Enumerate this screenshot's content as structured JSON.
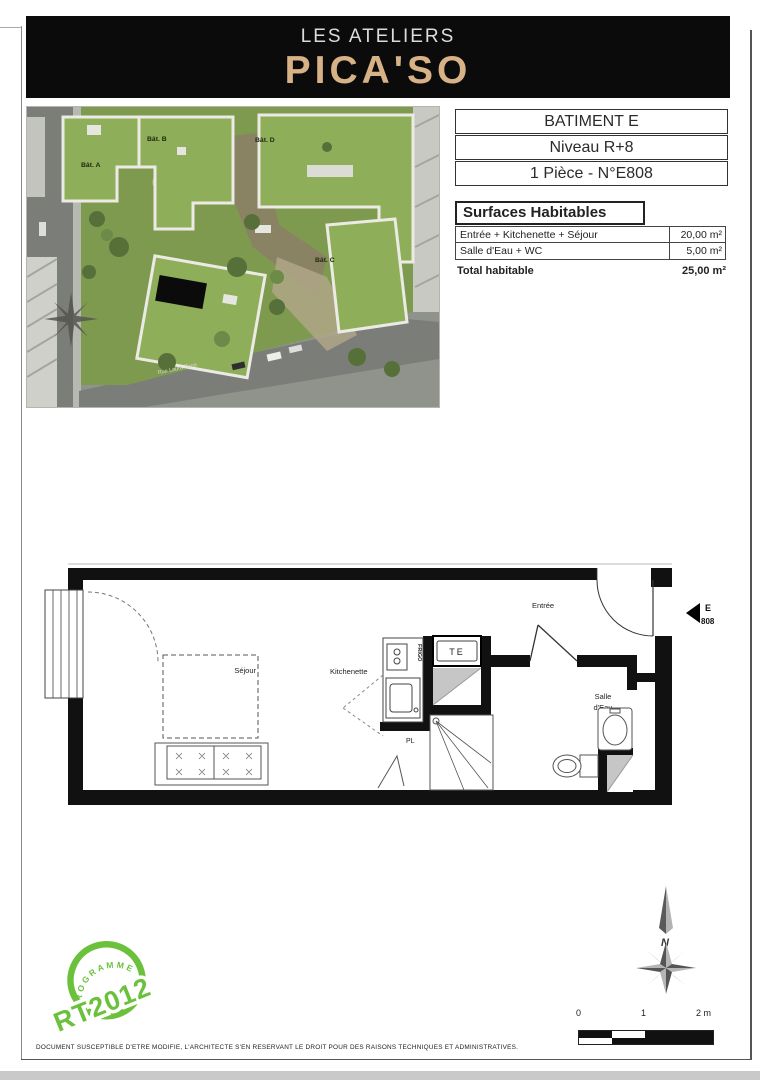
{
  "header": {
    "brand_line1": "LES ATELIERS",
    "brand_line2": "PICA'SO"
  },
  "site_photo": {
    "building_labels": [
      "Bât. A",
      "Bât. B",
      "Bât. D",
      "Bât. C"
    ],
    "street_name": "Rue Laura Zana"
  },
  "info_box": {
    "rows": [
      "BATIMENT E",
      "Niveau R+8",
      "1 Pièce - N°E808"
    ]
  },
  "surfaces": {
    "title": "Surfaces Habitables",
    "rows": [
      {
        "label": "Entrée + Kitchenette + Séjour",
        "value": "20,00 m²"
      },
      {
        "label": "Salle d'Eau + WC",
        "value": "5,00 m²"
      }
    ],
    "total_label": "Total habitable",
    "total_value": "25,00 m²"
  },
  "floor_plan": {
    "rooms": {
      "sejour": "Séjour",
      "kitchenette": "Kitchenette",
      "entree": "Entrée",
      "salle_line1": "Salle",
      "salle_line2": "d'Eau",
      "placard": "PL",
      "te": "TE",
      "frigo": "FRIGO"
    },
    "unit_marker": {
      "building": "E",
      "number": "808"
    }
  },
  "stamp": {
    "arc_text": "PROGRAMME",
    "main_text": "RT2012"
  },
  "compass": {
    "north_label": "N"
  },
  "scale_bar": {
    "ticks": [
      "0",
      "1",
      "2 m"
    ]
  },
  "footer": {
    "disclaimer": "DOCUMENT SUSCEPTIBLE D'ETRE MODIFIE, L'ARCHITECTE S'EN RESERVANT LE DROIT POUR DES RAISONS TECHNIQUES ET ADMINISTRATIVES."
  },
  "colors": {
    "brand_gold": "#d7b286",
    "stamp_green": "#6cc13c",
    "wall_black": "#111111",
    "shaft_gray": "#c6c6c6"
  }
}
